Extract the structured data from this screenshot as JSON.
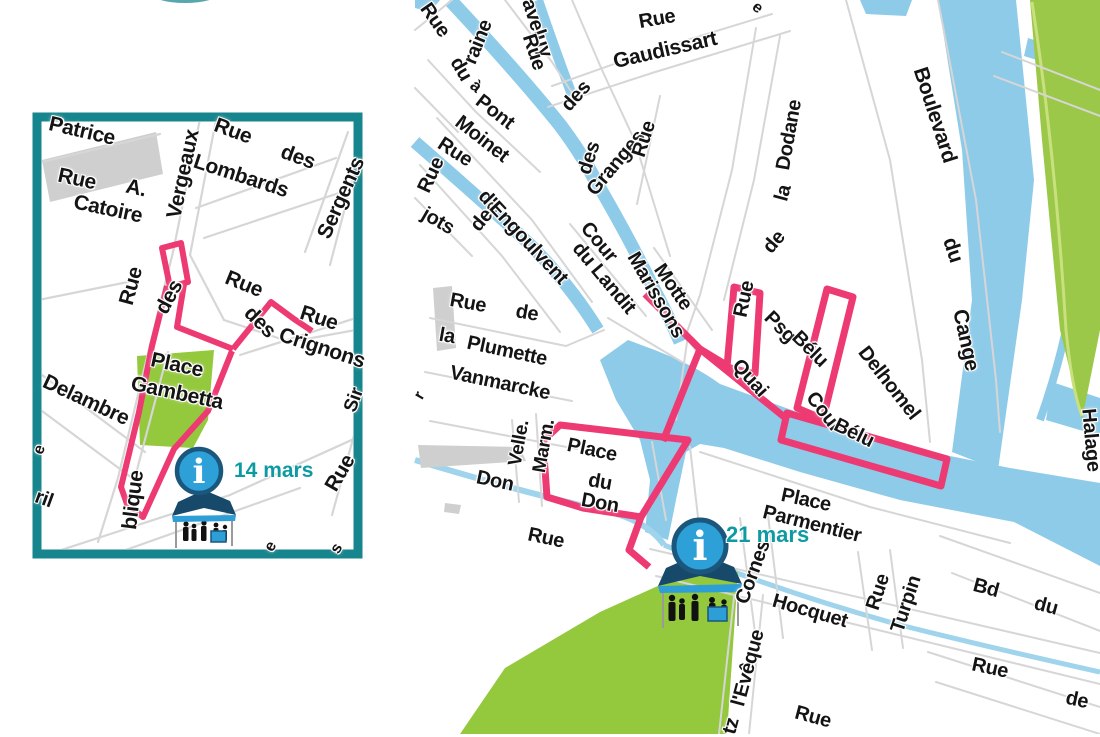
{
  "page": {
    "title": "Plan des animations - centre-ville et quartier Saint-Leu"
  },
  "colors": {
    "route_pink": "#ed3a72",
    "panel_teal": "#17858d",
    "water_blue": "#8ecbe9",
    "park_green": "#94c83d",
    "building_gray": "#cfcfcf",
    "street_gray": "#d6d6d6",
    "label_black": "#141414",
    "date_teal": "#0d9aa2",
    "info_blue": "#2da0d8",
    "info_ring": "#1b567c",
    "tent_navy": "#17496b"
  },
  "icons": {
    "info_glyph": "i",
    "info_icon": "info-icon",
    "kiosk_icon": "information-stand-icon"
  },
  "inset_map": {
    "marker": {
      "date": "14 mars"
    },
    "labels": [
      {
        "t": "Patrice",
        "x": 82,
        "y": 131,
        "r": 13,
        "s": 21
      },
      {
        "t": "Rue",
        "x": 77,
        "y": 179,
        "r": 12,
        "s": 21
      },
      {
        "t": "A.",
        "x": 136,
        "y": 188,
        "r": 12,
        "s": 21
      },
      {
        "t": "Catoire",
        "x": 108,
        "y": 209,
        "r": 12,
        "s": 21
      },
      {
        "t": "Vergeaux",
        "x": 183,
        "y": 174,
        "r": -78,
        "s": 21
      },
      {
        "t": "Rue",
        "x": 233,
        "y": 131,
        "r": 20,
        "s": 21
      },
      {
        "t": "des",
        "x": 298,
        "y": 157,
        "r": 20,
        "s": 21
      },
      {
        "t": "Lombards",
        "x": 241,
        "y": 176,
        "r": 18,
        "s": 21
      },
      {
        "t": "Sergents",
        "x": 341,
        "y": 198,
        "r": -66,
        "s": 21
      },
      {
        "t": "Rue",
        "x": 131,
        "y": 286,
        "r": -75,
        "s": 21
      },
      {
        "t": "des",
        "x": 169,
        "y": 297,
        "r": -62,
        "s": 21
      },
      {
        "t": "Rue",
        "x": 244,
        "y": 284,
        "r": 22,
        "s": 21
      },
      {
        "t": "des",
        "x": 260,
        "y": 322,
        "r": 45,
        "s": 21
      },
      {
        "t": "Rue",
        "x": 319,
        "y": 318,
        "r": 18,
        "s": 21
      },
      {
        "t": "Crignons",
        "x": 322,
        "y": 348,
        "r": 18,
        "s": 21
      },
      {
        "t": "Place",
        "x": 177,
        "y": 365,
        "r": 12,
        "s": 21
      },
      {
        "t": "Gambetta",
        "x": 177,
        "y": 393,
        "r": 12,
        "s": 21
      },
      {
        "t": "Delambre",
        "x": 86,
        "y": 400,
        "r": 25,
        "s": 21
      },
      {
        "t": "Sir",
        "x": 354,
        "y": 400,
        "r": -70,
        "s": 19
      },
      {
        "t": "Rue",
        "x": 340,
        "y": 473,
        "r": -60,
        "s": 21
      },
      {
        "t": "blique",
        "x": 133,
        "y": 500,
        "r": -83,
        "s": 21
      },
      {
        "t": "ril",
        "x": 44,
        "y": 499,
        "r": 20,
        "s": 20
      },
      {
        "t": "e",
        "x": 40,
        "y": 450,
        "r": -70,
        "s": 16
      },
      {
        "t": "e",
        "x": 271,
        "y": 547,
        "r": -60,
        "s": 16
      },
      {
        "t": "s",
        "x": 337,
        "y": 549,
        "r": -60,
        "s": 16
      }
    ]
  },
  "main_map": {
    "marker": {
      "date": "21 mars"
    },
    "labels": [
      {
        "t": "Rue",
        "x": 435,
        "y": 20,
        "r": 55,
        "s": 20
      },
      {
        "t": "raine",
        "x": 478,
        "y": 42,
        "r": -68,
        "s": 20
      },
      {
        "t": "aveluy",
        "x": 537,
        "y": 28,
        "r": 72,
        "s": 20
      },
      {
        "t": "Rue",
        "x": 534,
        "y": 52,
        "r": 72,
        "s": 20
      },
      {
        "t": "Rue",
        "x": 657,
        "y": 19,
        "r": -10,
        "s": 20
      },
      {
        "t": "Gaudissart",
        "x": 665,
        "y": 50,
        "r": -13,
        "s": 21
      },
      {
        "t": "e",
        "x": 757,
        "y": 8,
        "r": 40,
        "s": 16
      },
      {
        "t": "du",
        "x": 461,
        "y": 69,
        "r": 60,
        "s": 20
      },
      {
        "t": "à",
        "x": 476,
        "y": 86,
        "r": 40,
        "s": 17
      },
      {
        "t": "Pont",
        "x": 495,
        "y": 112,
        "r": 38,
        "s": 20
      },
      {
        "t": "Moinet",
        "x": 482,
        "y": 139,
        "r": 38,
        "s": 20
      },
      {
        "t": "Rue",
        "x": 455,
        "y": 152,
        "r": 33,
        "s": 20
      },
      {
        "t": "Rue",
        "x": 431,
        "y": 175,
        "r": -65,
        "s": 20
      },
      {
        "t": "des",
        "x": 485,
        "y": 216,
        "r": -50,
        "s": 20
      },
      {
        "t": "jots",
        "x": 438,
        "y": 221,
        "r": 30,
        "s": 20
      },
      {
        "t": "d'Engoulvent",
        "x": 523,
        "y": 237,
        "r": 47,
        "s": 20
      },
      {
        "t": "des",
        "x": 576,
        "y": 96,
        "r": -48,
        "s": 20
      },
      {
        "t": "Granges",
        "x": 616,
        "y": 163,
        "r": -50,
        "s": 20
      },
      {
        "t": "Rue",
        "x": 644,
        "y": 139,
        "r": -72,
        "s": 20
      },
      {
        "t": "des",
        "x": 589,
        "y": 158,
        "r": -72,
        "s": 20
      },
      {
        "t": "Cour",
        "x": 599,
        "y": 242,
        "r": 50,
        "s": 20
      },
      {
        "t": "du Landit",
        "x": 604,
        "y": 278,
        "r": 50,
        "s": 20
      },
      {
        "t": "Motte",
        "x": 673,
        "y": 287,
        "r": 55,
        "s": 20
      },
      {
        "t": "Marissons",
        "x": 656,
        "y": 295,
        "r": 60,
        "s": 20
      },
      {
        "t": "Rue",
        "x": 744,
        "y": 299,
        "r": -78,
        "s": 20
      },
      {
        "t": "de",
        "x": 774,
        "y": 242,
        "r": -50,
        "s": 20
      },
      {
        "t": "la",
        "x": 783,
        "y": 193,
        "r": -75,
        "s": 20
      },
      {
        "t": "Dodane",
        "x": 789,
        "y": 135,
        "r": -80,
        "s": 20
      },
      {
        "t": "Quai",
        "x": 750,
        "y": 378,
        "r": 48,
        "s": 20
      },
      {
        "t": "Psg",
        "x": 780,
        "y": 327,
        "r": 45,
        "s": 20
      },
      {
        "t": "Bélu",
        "x": 810,
        "y": 349,
        "r": 45,
        "s": 20
      },
      {
        "t": "Cour",
        "x": 824,
        "y": 412,
        "r": 52,
        "s": 20
      },
      {
        "t": "Bélu",
        "x": 854,
        "y": 433,
        "r": 26,
        "s": 20
      },
      {
        "t": "Delhomel",
        "x": 889,
        "y": 383,
        "r": 52,
        "s": 20
      },
      {
        "t": "Boulevard",
        "x": 935,
        "y": 115,
        "r": 72,
        "s": 21
      },
      {
        "t": "du",
        "x": 953,
        "y": 250,
        "r": 72,
        "s": 21
      },
      {
        "t": "Cange",
        "x": 966,
        "y": 340,
        "r": 78,
        "s": 21
      },
      {
        "t": "Halage",
        "x": 1091,
        "y": 440,
        "r": 85,
        "s": 20
      },
      {
        "t": "Rue",
        "x": 468,
        "y": 303,
        "r": 10,
        "s": 20
      },
      {
        "t": "de",
        "x": 527,
        "y": 313,
        "r": 10,
        "s": 20
      },
      {
        "t": "la",
        "x": 447,
        "y": 336,
        "r": 10,
        "s": 20
      },
      {
        "t": "Plumette",
        "x": 507,
        "y": 351,
        "r": 12,
        "s": 20
      },
      {
        "t": "Vanmarcke",
        "x": 500,
        "y": 383,
        "r": 12,
        "s": 20
      },
      {
        "t": "r",
        "x": 420,
        "y": 396,
        "r": -60,
        "s": 16
      },
      {
        "t": "Velle.",
        "x": 519,
        "y": 443,
        "r": -80,
        "s": 19
      },
      {
        "t": "Marm.",
        "x": 544,
        "y": 446,
        "r": -80,
        "s": 19
      },
      {
        "t": "Place",
        "x": 592,
        "y": 450,
        "r": 12,
        "s": 20
      },
      {
        "t": "du",
        "x": 600,
        "y": 482,
        "r": 10,
        "s": 20
      },
      {
        "t": "Don",
        "x": 600,
        "y": 503,
        "r": 10,
        "s": 20
      },
      {
        "t": "Don",
        "x": 495,
        "y": 481,
        "r": 12,
        "s": 20
      },
      {
        "t": "Rue",
        "x": 546,
        "y": 538,
        "r": 12,
        "s": 20
      },
      {
        "t": "Place",
        "x": 806,
        "y": 500,
        "r": 12,
        "s": 20
      },
      {
        "t": "Parmentier",
        "x": 812,
        "y": 524,
        "r": 14,
        "s": 20
      },
      {
        "t": "Cornes",
        "x": 753,
        "y": 572,
        "r": -70,
        "s": 20
      },
      {
        "t": "Hocquet",
        "x": 810,
        "y": 611,
        "r": 16,
        "s": 20
      },
      {
        "t": "Rue",
        "x": 878,
        "y": 592,
        "r": -72,
        "s": 20
      },
      {
        "t": "Turpin",
        "x": 906,
        "y": 604,
        "r": -72,
        "s": 20
      },
      {
        "t": "Bd",
        "x": 986,
        "y": 588,
        "r": 15,
        "s": 20
      },
      {
        "t": "du",
        "x": 1046,
        "y": 606,
        "r": 15,
        "s": 20
      },
      {
        "t": "Rue",
        "x": 990,
        "y": 668,
        "r": 12,
        "s": 20
      },
      {
        "t": "de",
        "x": 1077,
        "y": 700,
        "r": 12,
        "s": 20
      },
      {
        "t": "l'Evêque",
        "x": 748,
        "y": 668,
        "r": -75,
        "s": 20
      },
      {
        "t": "tz",
        "x": 731,
        "y": 726,
        "r": -75,
        "s": 20
      },
      {
        "t": "Rue",
        "x": 813,
        "y": 717,
        "r": 15,
        "s": 20
      }
    ]
  }
}
